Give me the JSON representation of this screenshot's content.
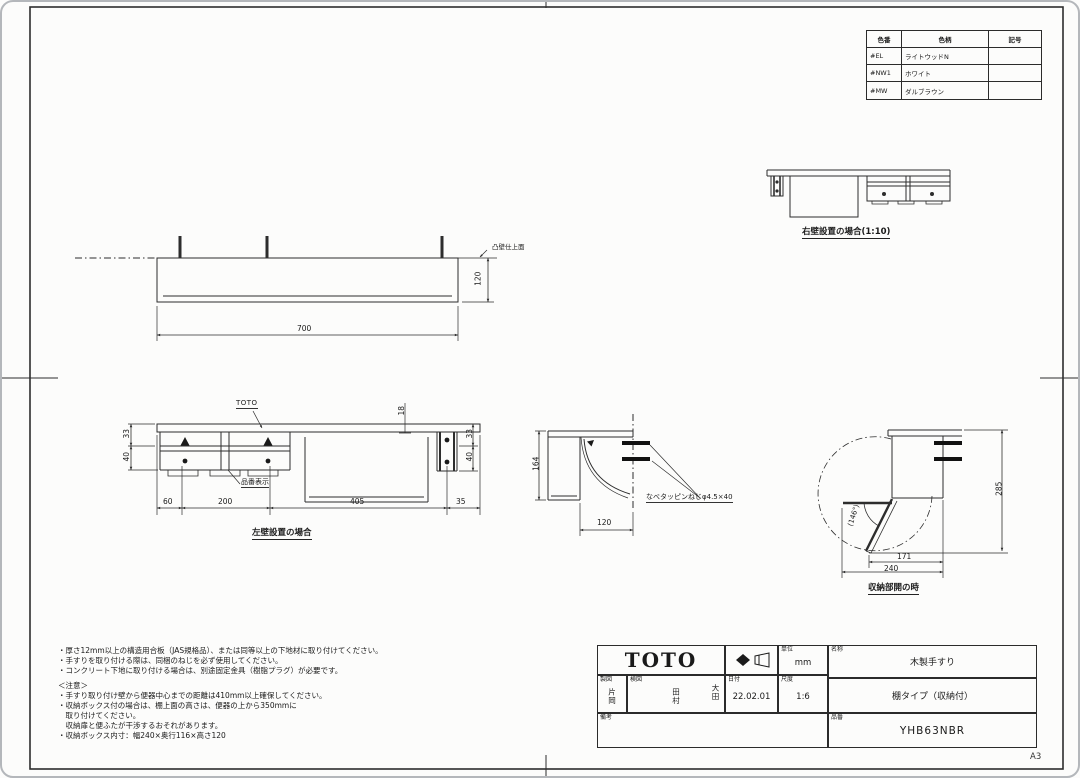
{
  "sheet_label": "A3",
  "color_table": {
    "headers": {
      "code": "色番",
      "name": "色柄",
      "symbol": "記号"
    },
    "rows": [
      {
        "code": "#EL",
        "name": "ライトウッドN",
        "symbol": ""
      },
      {
        "code": "#NW1",
        "name": "ホワイト",
        "symbol": ""
      },
      {
        "code": "#MW",
        "name": "ダルブラウン",
        "symbol": ""
      }
    ]
  },
  "views": {
    "right_wall": {
      "caption": "右壁設置の場合(1:10)"
    },
    "plan": {
      "width": "700",
      "depth": "120",
      "wall_label": "凸壁仕上面"
    },
    "front": {
      "caption": "左壁設置の場合",
      "brand": "TOTO",
      "part_display": "品番表示",
      "d_left_top": "33",
      "d_left_bottom": "40",
      "d_top": "18",
      "d_right_top": "33",
      "d_right_bottom": "40",
      "d1": "60",
      "d2": "200",
      "d3": "405",
      "d4": "35"
    },
    "side": {
      "height": "164",
      "depth": "120",
      "screw": "なべタッピンねじφ4.5×40"
    },
    "open": {
      "caption": "収納部開の時",
      "height": "285",
      "w1": "171",
      "w2": "240",
      "angle": "(146°)"
    }
  },
  "notes": {
    "lines": [
      "・厚さ12mm以上の構造用合板（JAS規格品）、または同等以上の下地材に取り付けてください。",
      "・手すりを取り付ける際は、同梱のねじを必ず使用してください。",
      "・コンクリート下地に取り付ける場合は、別途固定金具（樹脂プラグ）が必要です。"
    ],
    "caution_title": "＜注意＞",
    "caution_lines": [
      "・手すり取り付け壁から便器中心までの距離は410mm以上確保してください。",
      "・収納ボックス付の場合は、棚上面の高さは、便器の上から350mmに",
      "　取り付けてください。",
      "　収納扉と便ふたが干渉するおそれがあります。",
      "・収納ボックス内寸：幅240×奥行116×高さ120"
    ]
  },
  "title_block": {
    "brand": "TOTO",
    "unit_label": "単位",
    "unit_value": "mm",
    "name_label": "名称",
    "name_value": "木製手すり",
    "type_value": "棚タイプ（収納付）",
    "drafter_label": "製図",
    "drafter_name": "片岡",
    "checker_label": "検図",
    "checker_name1": "田村",
    "checker_name2": "大田",
    "date_label": "日付",
    "date_value": "22.02.01",
    "scale_label": "尺度",
    "scale_value": "1:6",
    "remarks_label": "備考",
    "part_label": "品番",
    "part_value": "YHB63NBR"
  }
}
